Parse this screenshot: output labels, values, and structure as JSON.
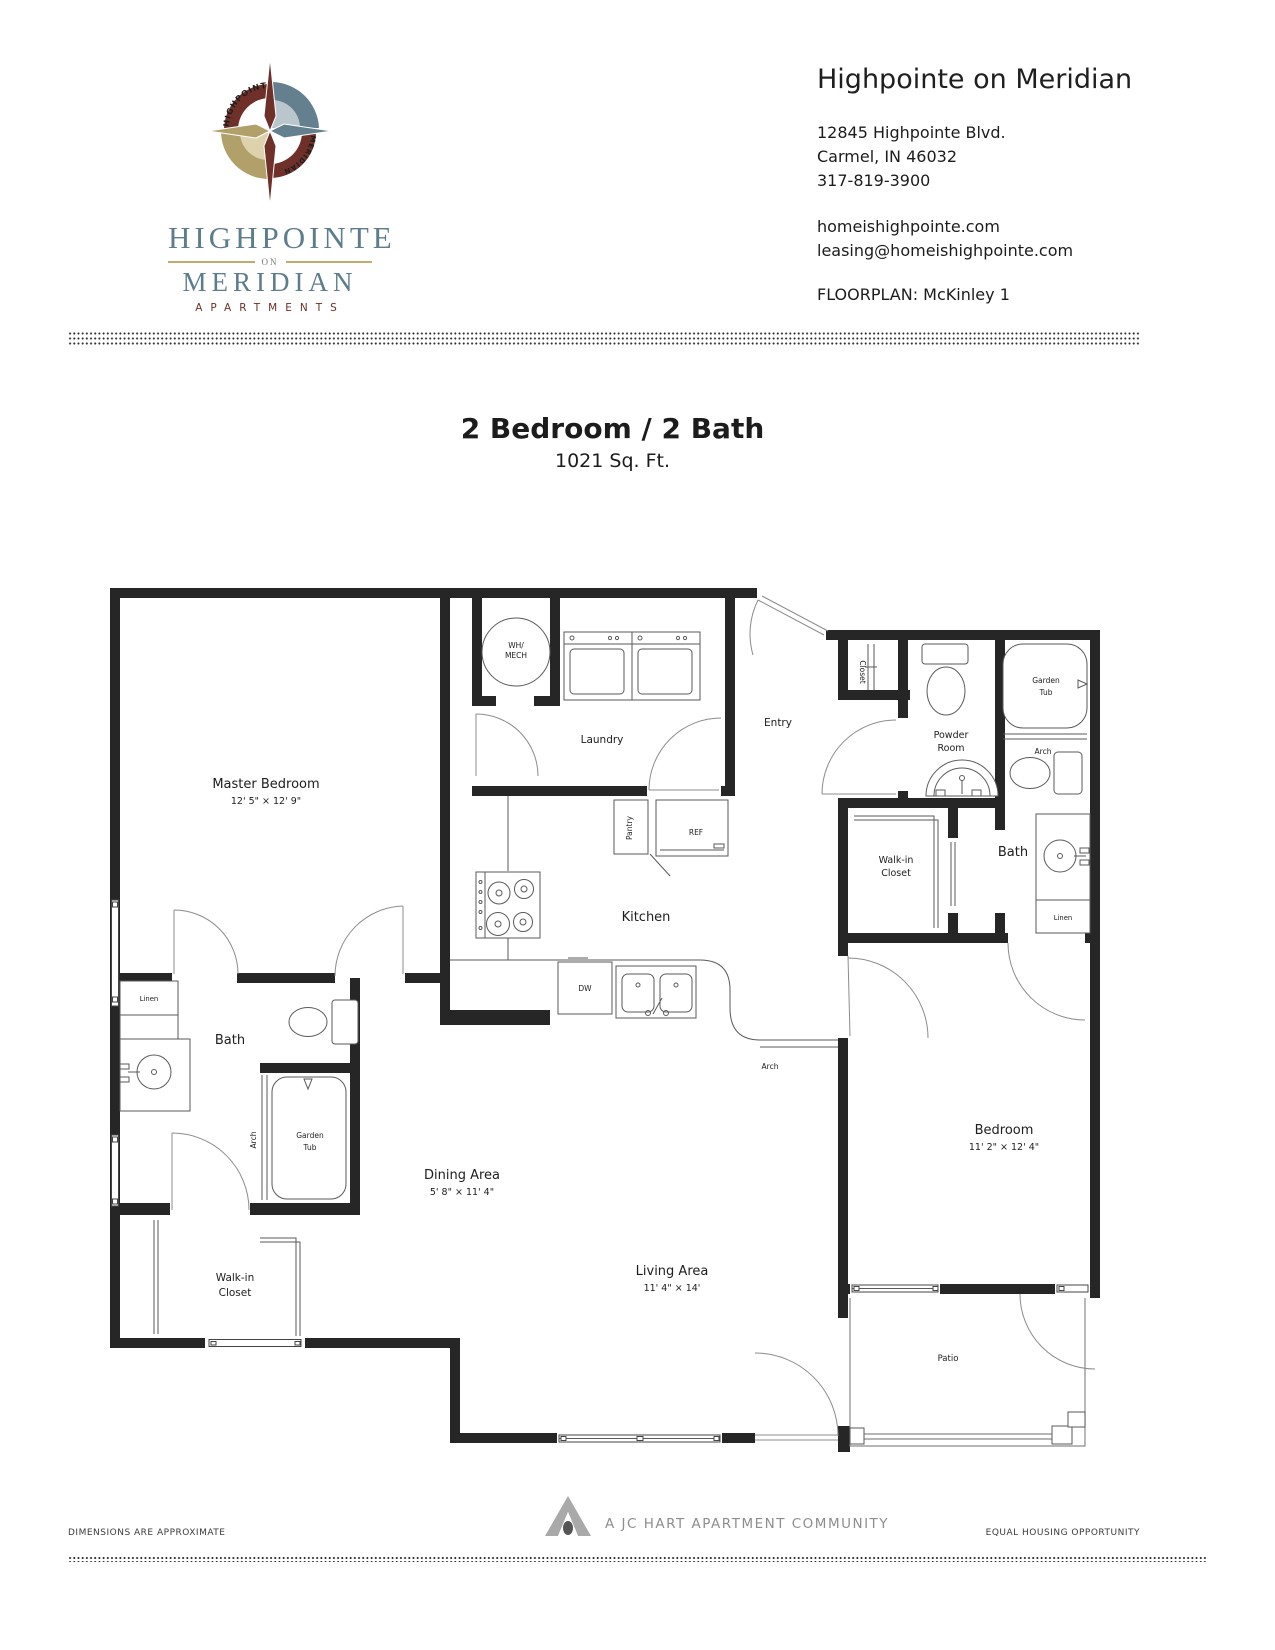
{
  "brand": {
    "slate": "#5e7d8c",
    "tan": "#bfa76f",
    "maroon": "#6e3028",
    "wall_color": "#262626"
  },
  "header": {
    "compass": {
      "top_text": "HIGHPOINTE",
      "bottom_text": "MERIDIAN"
    },
    "wordmark": {
      "line1": "HIGHPOINTE",
      "on": "ON",
      "line2": "MERIDIAN",
      "line3": "APARTMENTS"
    },
    "property_name": "Highpointe on Meridian",
    "address_line1": "12845 Highpointe Blvd.",
    "address_line2": "Carmel, IN 46032",
    "phone": "317-819-3900",
    "website": "homeishighpointe.com",
    "email": "leasing@homeishighpointe.com",
    "floorplan_label": "FLOORPLAN: McKinley 1"
  },
  "title": {
    "main": "2 Bedroom / 2 Bath",
    "sqft": "1021 Sq. Ft."
  },
  "plan": {
    "labels": {
      "master": {
        "name": "Master Bedroom",
        "dims": "12' 5\" × 12' 9\""
      },
      "laundry": "Laundry",
      "wh": {
        "l1": "WH/",
        "l2": "MECH"
      },
      "entry": "Entry",
      "entry_closet": "Closet",
      "powder": {
        "l1": "Powder",
        "l2": "Room"
      },
      "garden_tub_right": {
        "l1": "Garden",
        "l2": "Tub"
      },
      "arch_right": "Arch",
      "bath_right": "Bath",
      "linen_right": "Linen",
      "walkin_right": {
        "l1": "Walk-in",
        "l2": "Closet"
      },
      "pantry": "Pantry",
      "ref": "REF",
      "dw": "DW",
      "kitchen": "Kitchen",
      "arch_center": "Arch",
      "dining": {
        "name": "Dining Area",
        "dims": "5' 8\" × 11' 4\""
      },
      "living": {
        "name": "Living Area",
        "dims": "11' 4\" × 14'"
      },
      "bedroom": {
        "name": "Bedroom",
        "dims": "11' 2\" × 12' 4\""
      },
      "linen_left": "Linen",
      "bath_left": "Bath",
      "garden_tub_left": {
        "l1": "Garden",
        "l2": "Tub"
      },
      "arch_left": "Arch",
      "walkin_left": {
        "l1": "Walk-in",
        "l2": "Closet"
      },
      "patio": "Patio"
    }
  },
  "footer": {
    "left": "DIMENSIONS ARE APPROXIMATE",
    "center": "A JC HART APARTMENT COMMUNITY",
    "right": "EQUAL HOUSING OPPORTUNITY"
  }
}
